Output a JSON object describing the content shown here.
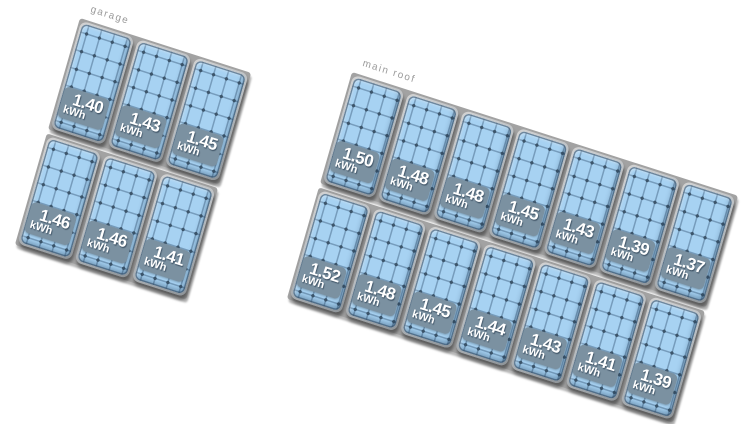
{
  "canvas": {
    "background": "#ffffff"
  },
  "unit": "kWh",
  "arrays": [
    {
      "id": "garage",
      "label": "garage",
      "unit": "kWh",
      "rows": [
        [
          "1.40",
          "1.43",
          "1.45"
        ],
        [
          "1.46",
          "1.46",
          "1.41"
        ]
      ]
    },
    {
      "id": "main-roof",
      "label": "main roof",
      "unit": "kWh",
      "rows": [
        [
          "1.50",
          "1.48",
          "1.48",
          "1.45",
          "1.43",
          "1.39",
          "1.37"
        ],
        [
          "1.52",
          "1.48",
          "1.45",
          "1.44",
          "1.43",
          "1.41",
          "1.39"
        ]
      ]
    }
  ],
  "colors": {
    "background": "#ffffff",
    "panel-fill": "#a7d2f2",
    "grid-line": "#769cbc",
    "cell-dot": "#3c556b",
    "badge-bg": "#7b91a1",
    "badge-text": "#ffffff",
    "backing": "#a2a2a2",
    "roof-label": "#9a9a9a"
  }
}
